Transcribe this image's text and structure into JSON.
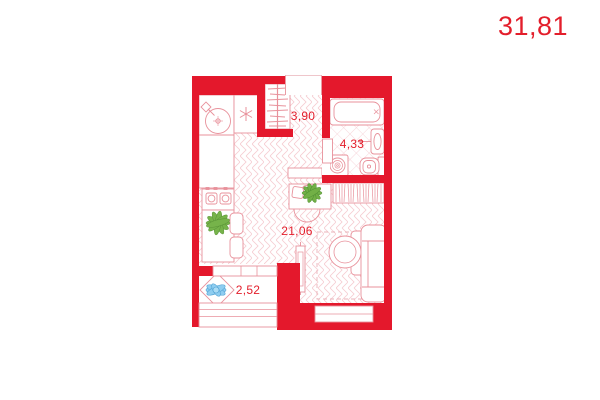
{
  "header": {
    "total_area": "31,81"
  },
  "plan": {
    "rooms": [
      {
        "name": "hallway",
        "area": "3,90"
      },
      {
        "name": "bathroom",
        "area": "4,33"
      },
      {
        "name": "living-kitchen",
        "area": "21,06"
      },
      {
        "name": "balcony",
        "area": "2,52"
      }
    ],
    "colors": {
      "wall_red": "#e4182c",
      "label_red": "#e31e2b",
      "furniture_outline": "#e8919b",
      "floor_pattern": "#f5ccd1",
      "plant_green": "#76b34a",
      "plant_blue": "#8ecdf0",
      "background": "#ffffff"
    },
    "icons": [
      "snowflake-icon",
      "kitchen-sink-icon",
      "stove-icon",
      "wardrobe-icon",
      "bathtub-icon",
      "washbasin-icon",
      "toilet-icon",
      "washing-machine-icon",
      "dining-table-icon",
      "tv-stand-icon",
      "armchair-icon",
      "sofa-icon",
      "plant-icon",
      "balcony-plant-icon",
      "rug-icon",
      "shelving-icon"
    ]
  }
}
